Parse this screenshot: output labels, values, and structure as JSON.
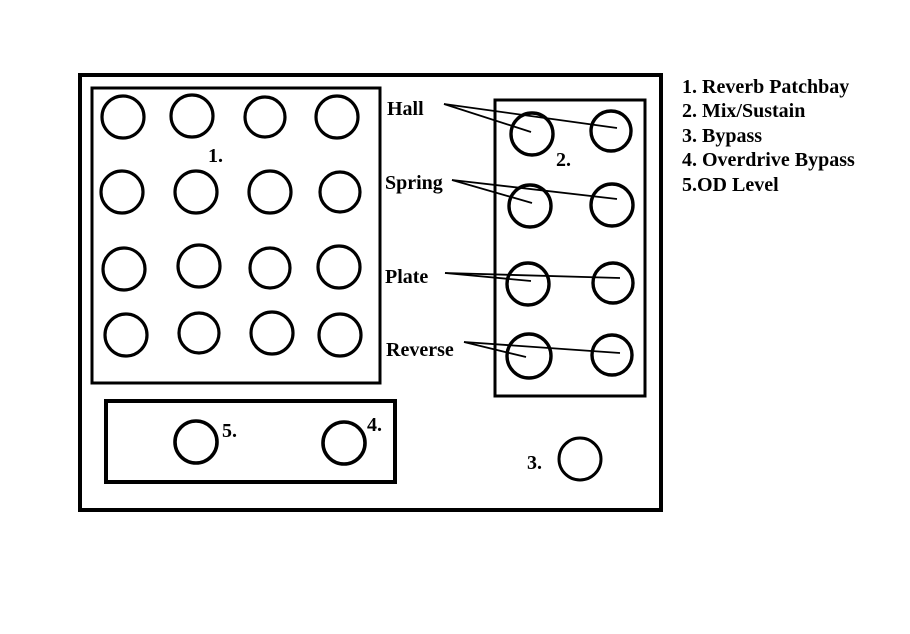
{
  "colors": {
    "background": "#ffffff",
    "ink": "#000000"
  },
  "legend": {
    "items": [
      "1. Reverb Patchbay",
      "2. Mix/Sustain",
      "3. Bypass",
      "4. Overdrive Bypass",
      "5.OD Level"
    ]
  },
  "patchbay": {
    "number_label": "1."
  },
  "reverb_panel": {
    "number_label": "2.",
    "row_labels": [
      "Hall",
      "Spring",
      "Plate",
      "Reverse"
    ]
  },
  "bypass": {
    "number_label": "3."
  },
  "overdrive_box": {
    "od_level_label": "5.",
    "overdrive_bypass_label": "4."
  }
}
